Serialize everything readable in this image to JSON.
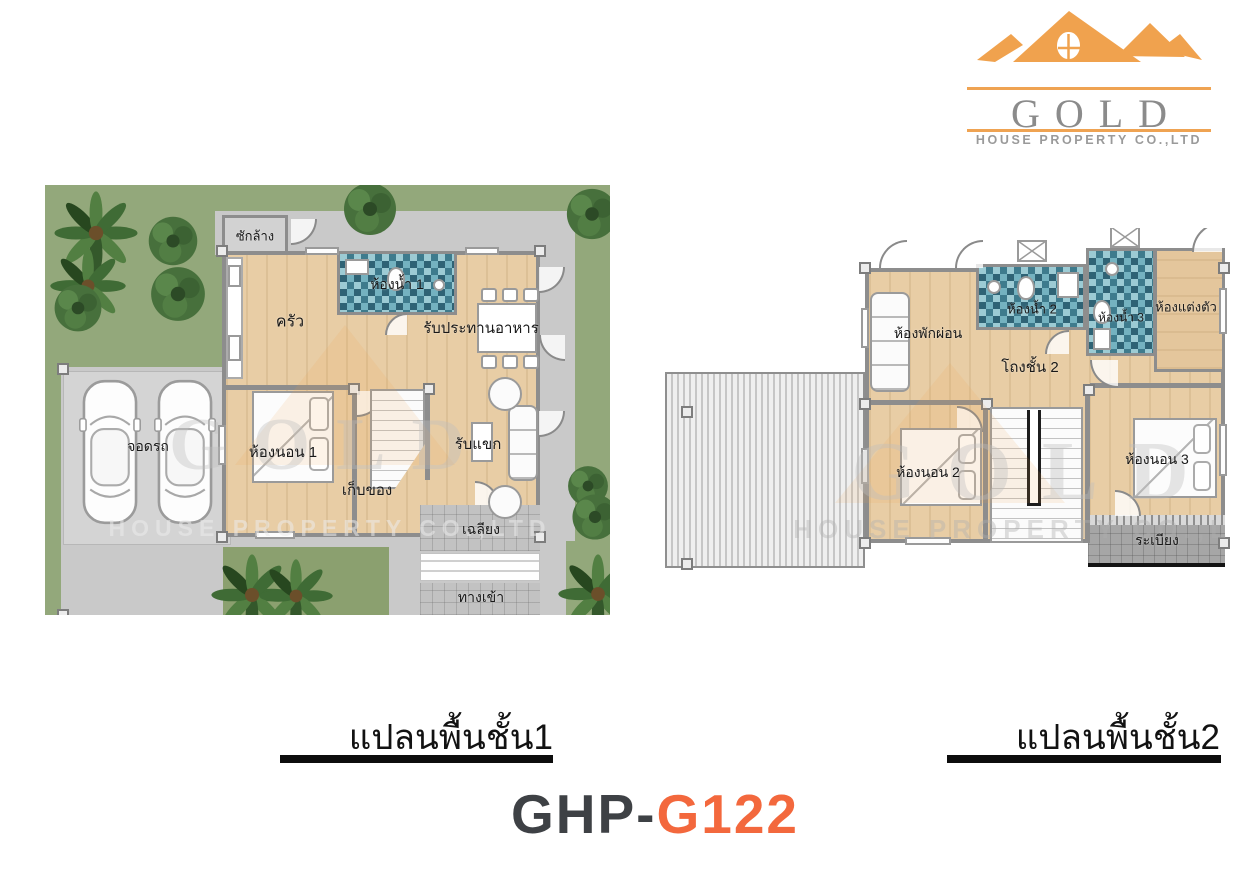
{
  "logo": {
    "title": "GOLD",
    "subtitle": "HOUSE PROPERTY CO.,LTD",
    "icon": "roof-mountains-icon"
  },
  "plans": {
    "plan1": {
      "caption": "แปลนพื้นชั้น1",
      "rooms": {
        "laundry": "ซักล้าง",
        "bathroom1": "ห้องน้ำ 1",
        "kitchen": "ครัว",
        "dining": "รับประทานอาหาร",
        "bedroom1": "ห้องนอน 1",
        "storage": "เก็บของ",
        "living": "รับแขก",
        "porch": "เฉลียง",
        "entrance": "ทางเข้า",
        "carport": "จอดรถ"
      }
    },
    "plan2": {
      "caption": "แปลนพื้นชั้น2",
      "rooms": {
        "family": "ห้องพักผ่อน",
        "bathroom2": "ห้องน้ำ 2",
        "bathroom3": "ห้องน้ำ 3",
        "dressing": "ห้องแต่งตัว",
        "hall": "โถงชั้น 2",
        "bedroom2": "ห้องนอน 2",
        "bedroom3": "ห้องนอน 3",
        "balcony": "ระเบียง"
      }
    }
  },
  "model": {
    "prefix": "GHP-",
    "code": "G122"
  },
  "watermark": {
    "title": "GOLD",
    "subtitle": "HOUSE PROPERTY CO.,LTD"
  },
  "colors": {
    "logo_orange": "#F0A24E",
    "logo_gray": "#8B8B8B",
    "model_prefix_color": "#3E4145",
    "model_code_color": "#F3683D",
    "grass": "#93A87B",
    "wood_floor": "#E8CDA5",
    "bath_tile": "#4E8FA0",
    "pavement": "#C9C9C9",
    "caption_color": "#111111"
  }
}
